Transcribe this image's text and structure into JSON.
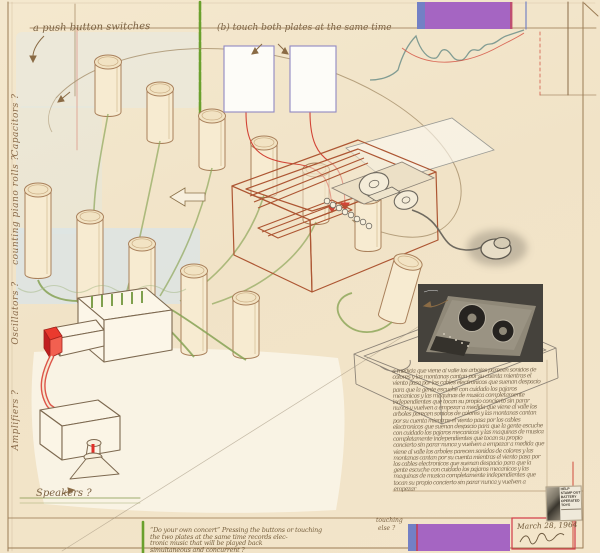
{
  "annotations": {
    "top_left": "a push button switches",
    "top_middle": "(b) touch both plates at the same time",
    "side_labels": [
      "Capacitors ?",
      "counting piano rolls ?",
      "Oscillators ?",
      "Amplifiers ?"
    ],
    "speakers": "Speakers ?",
    "bottom_lines": [
      "“Do your own concert”   Pressing the buttons or touching",
      "the two plates at the same time   records elec-",
      "tronic music that will be played back",
      "simultaneous and concurrent ?"
    ],
    "margin_lines": [
      "touching",
      "else ?"
    ]
  },
  "colophon": {
    "date": "March 28, 1964"
  },
  "sticker": {
    "lines": [
      "HELP",
      "STAMP OUT",
      "BATTERY",
      "OPERATED",
      "TOYS"
    ]
  },
  "scribble": {
    "text": "a medida que viene al valle los arboles parecen sonidos de colores y las montanas cantan por su cuenta mientras el viento pasa por los cables electronicos que suenan despacio para que la gente escuche con cuidado los pajaros mecanicos y las maquinas de musica completamente independientes que tocan su propio concierto sin parar nunca y vuelven a empezar "
  },
  "colors": {
    "paper": "#f1e3c7",
    "purple_bar": "#a565c2",
    "blue_stripe": "#7380c5",
    "green_rule": "#6aa02c",
    "red_ink": "#d24436",
    "sepia_ink": "#9b7c55",
    "pencil": "#8d8478",
    "photo_bg": "#45423c"
  }
}
